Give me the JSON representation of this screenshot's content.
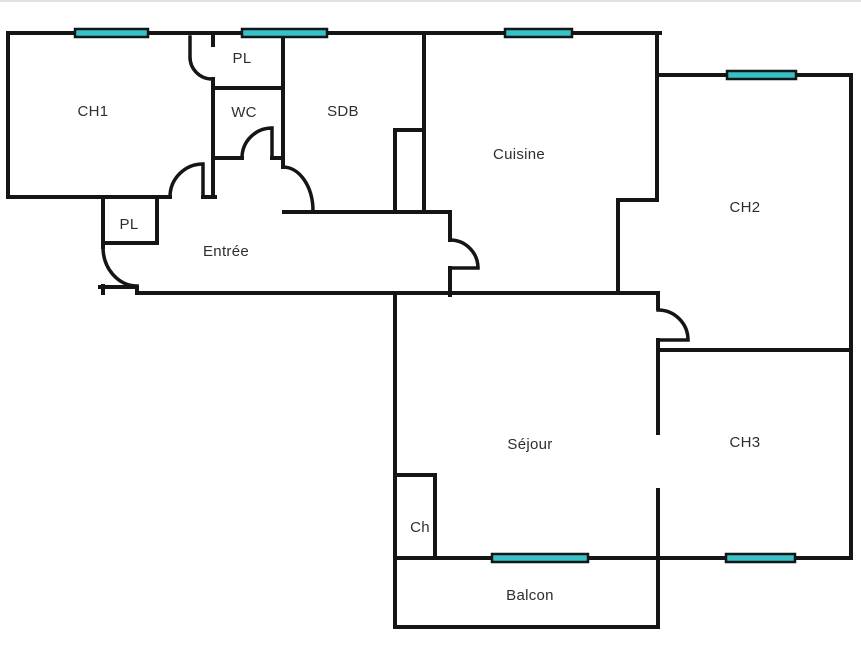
{
  "colors": {
    "background": "#ffffff",
    "wall": "#151515",
    "door": "#151515",
    "window_fill": "#2fc5c9",
    "window_border": "#151515",
    "label": "#2e2e2e",
    "frame": "#d8d8d8"
  },
  "rooms": {
    "ch1": "CH1",
    "pl_top": "PL",
    "wc": "WC",
    "sdb": "SDB",
    "cuisine": "Cuisine",
    "ch2": "CH2",
    "entree": "Entrée",
    "pl_hall": "PL",
    "sejour": "Séjour",
    "ch3": "CH3",
    "ch_closet": "Ch",
    "balcon": "Balcon"
  }
}
